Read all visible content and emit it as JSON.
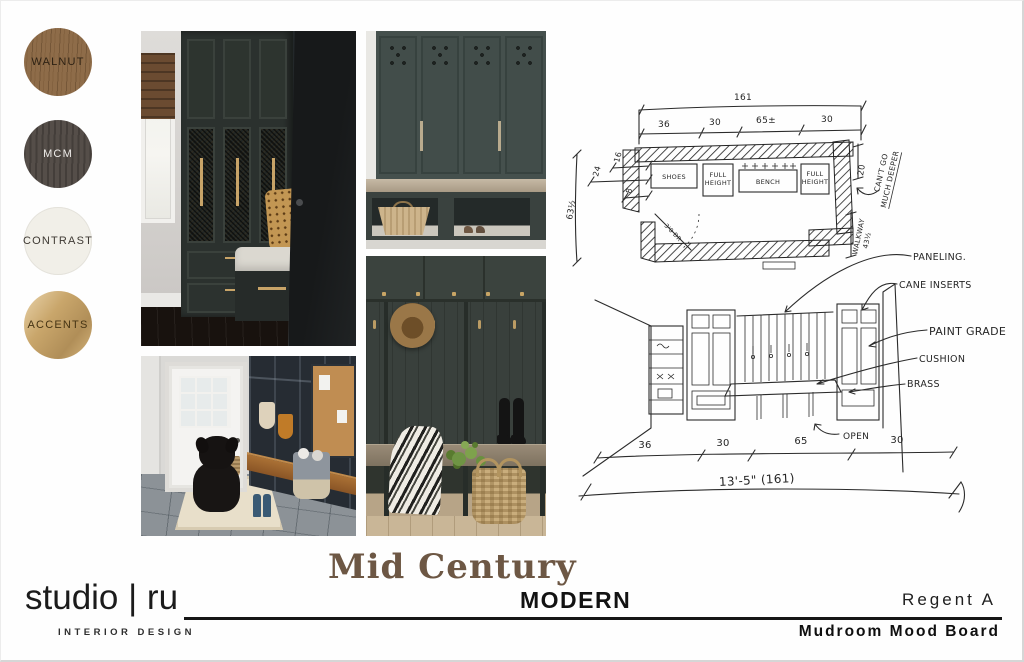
{
  "swatches": [
    {
      "label": "WALNUT",
      "bg": "#8e6c49",
      "fg": "#2e2214"
    },
    {
      "label": "MCM",
      "bg": "#554e49",
      "fg": "#efedea"
    },
    {
      "label": "CONTRAST",
      "bg": "#f1efe8",
      "fg": "#3e3933"
    },
    {
      "label": "ACCENTS",
      "bg": "#c9a66b",
      "fg": "#463414"
    }
  ],
  "plan": {
    "dim_total": "161",
    "seg_1": "36",
    "seg_2": "30",
    "seg_3": "65±",
    "seg_4": "30",
    "left_total": "63½",
    "left_a": "24",
    "left_b": "16",
    "left_c": "8",
    "right_depth": "20",
    "walkway_label": "WALKWAY",
    "walkway_dim": "43½",
    "note_1": "CAN'T GO",
    "note_2": "MUCH DEEPER",
    "door": "3'0 DR",
    "label_shoes": "SHOES",
    "label_full": "FULL",
    "label_height": "HEIGHT",
    "label_bench": "BENCH"
  },
  "elevation": {
    "callout_paneling": "PANELING.",
    "callout_cane": "CANE INSERTS",
    "callout_paint": "PAINT GRADE",
    "callout_cushion": "CUSHION",
    "callout_brass": "BRASS",
    "callout_open": "OPEN",
    "dim_1": "36",
    "dim_2": "30",
    "dim_3": "65",
    "dim_4": "30",
    "dim_total_label": "13'-5\" (161)"
  },
  "footer": {
    "logo_name": "studio | ru",
    "logo_tagline": "INTERIOR DESIGN",
    "title_script": "Mid Century",
    "title_sub": "MODERN",
    "project_name": "Regent A",
    "board_name": "Mudroom Mood Board"
  },
  "colors": {
    "title_brown": "#6d5744"
  }
}
